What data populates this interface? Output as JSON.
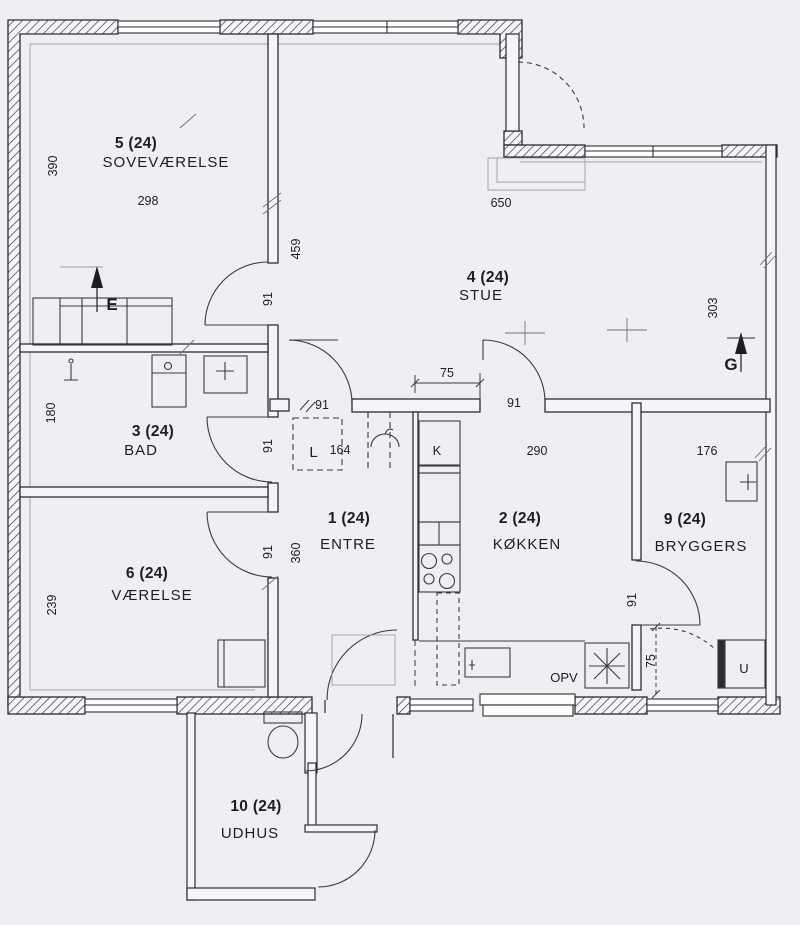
{
  "plan": {
    "title": "Floor plan",
    "rooms": [
      {
        "number": "5 (24)",
        "name": "SOVEVÆRELSE"
      },
      {
        "number": "4 (24)",
        "name": "STUE"
      },
      {
        "number": "3 (24)",
        "name": "BAD"
      },
      {
        "number": "1 (24)",
        "name": "ENTRE"
      },
      {
        "number": "2 (24)",
        "name": "KØKKEN"
      },
      {
        "number": "9 (24)",
        "name": "BRYGGERS"
      },
      {
        "number": "6 (24)",
        "name": "VÆRELSE"
      },
      {
        "number": "10 (24)",
        "name": "UDHUS"
      }
    ],
    "dims": {
      "bedroom_width": "298",
      "bedroom_depth": "390",
      "bedroom_wall": "459",
      "living_width": "650",
      "living_depth": "303",
      "bath_depth": "180",
      "hall_closet": "164",
      "hall_depth": "360",
      "kitchen_width": "290",
      "utility_width": "176",
      "room6_depth": "239",
      "passage": "75",
      "utility_door": "75",
      "door_a": "91",
      "door_b": "91",
      "door_c": "91",
      "door_d": "91",
      "door_e": "91",
      "door_f": "91"
    },
    "markers": {
      "e": "E",
      "g": "G",
      "l": "L",
      "k": "K",
      "u": "U",
      "opv": "OPV"
    },
    "colors": {
      "line": "#2c2d31",
      "light_line": "#9aa0a8",
      "paper": "#edeff3"
    }
  }
}
